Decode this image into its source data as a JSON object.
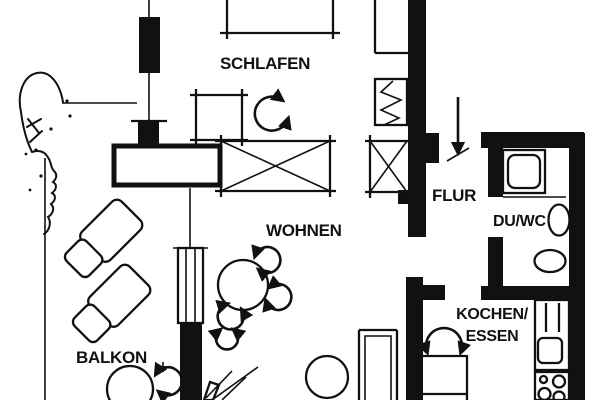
{
  "colors": {
    "ink": "#111111",
    "paper": "#ffffff"
  },
  "rooms": {
    "schlafen": {
      "label": "SCHLAFEN"
    },
    "wohnen": {
      "label": "WOHNEN"
    },
    "balkon": {
      "label": "BALKON"
    },
    "flur": {
      "label": "FLUR"
    },
    "du_wc": {
      "label": "DU/WC"
    },
    "kochen_essen": {
      "label_line1": "KOCHEN/",
      "label_line2": "ESSEN"
    }
  },
  "legend": {
    "entrance-arrow-icon": "down arrow marking apartment entrance",
    "door-swing-icon": "arc with arrowheads (door swing)",
    "radiator-icon": "rectangle with zigzag",
    "wardrobe-crossed-icon": "rectangle with X",
    "shower-icon": "square with rounded inner tray",
    "washbasin-icon": "oval basin on wall",
    "wc-icon": "oval toilet bowl",
    "sink-icon": "rounded square in counter",
    "stove-icon": "four burner circles",
    "window-icon": "double-line glazing in wall",
    "lounge-chair-icon": "45-degree rotated chair with backrest",
    "round-table-icon": "circle",
    "chair-arrow-icon": "open circular arrow around table",
    "plant-icon": "radiating leaf lines",
    "tree-sketch": "freehand organic outline with dots"
  }
}
